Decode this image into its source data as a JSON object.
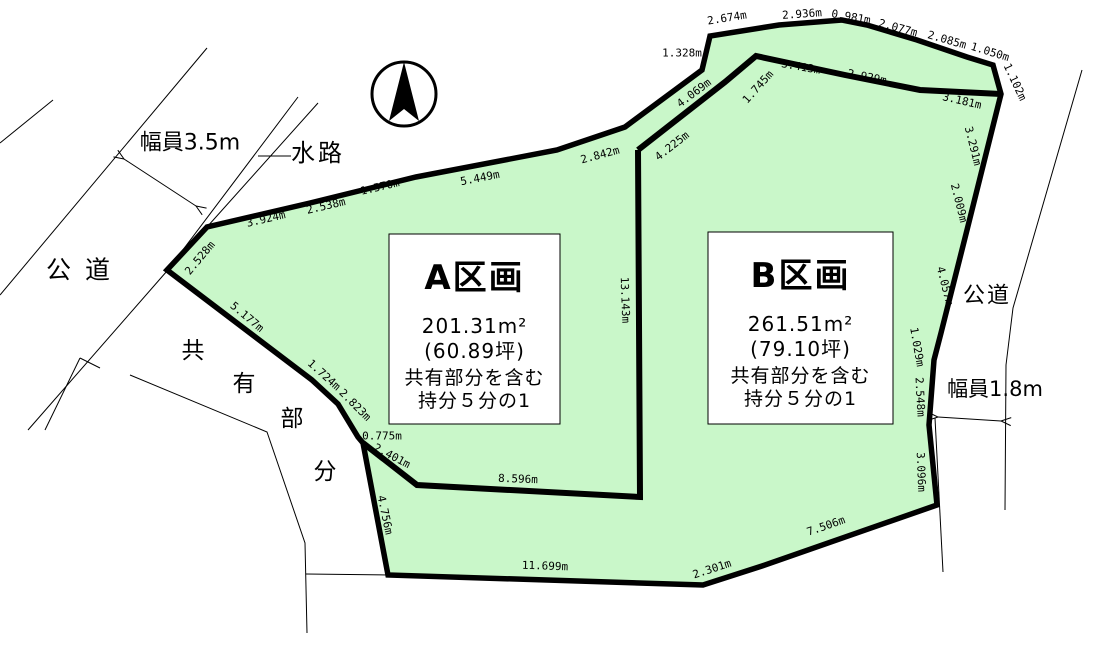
{
  "colors": {
    "land_fill": "#c9f7c9",
    "line": "#000000",
    "background": "#ffffff",
    "box_fill": "#ffffff"
  },
  "compass": {
    "name": "north-compass",
    "cx": 404,
    "cy": 94,
    "r": 32,
    "needle_points": "404,62 419,121 404,109 389,121"
  },
  "outer_boundary": {
    "name": "land-outer-boundary",
    "points": "167,270 207,227 310,203 375,187 416,177 557,150 625,127 702,70 710,36 779,25 842,20 867,25 917,40 967,57 993,65 1001,94 980,178 967,230 941,333 934,360 929,425 937,505 762,566 703,585 388,575 363,443 358,437 338,404 312,380"
  },
  "inner_lines": [
    {
      "name": "parcel-divider-line",
      "points": "638,150 640,497 417,485 363,443"
    },
    {
      "name": "north-strip-inner-line",
      "points": "638,150 725,82 756,56 845,75 920,90 1001,94"
    }
  ],
  "thin_lines": [
    {
      "name": "west-road-west-edge-line",
      "points": "207,48 0,295"
    },
    {
      "name": "west-road-far-edge-line",
      "points": "53,100 0,143"
    },
    {
      "name": "waterway-west-edge-line",
      "points": "298,97 167,271 28,430"
    },
    {
      "name": "waterway-east-edge-line",
      "points": "318,103 207,227"
    },
    {
      "name": "waterway-leader-line",
      "points": "258,156 291,156"
    },
    {
      "name": "shared-area-west-boundary-line",
      "points": "130,375 267,432 305,543 307,633"
    },
    {
      "name": "shared-area-bottom-line",
      "points": "306,574 388,575"
    },
    {
      "name": "parcel-jog-line-1",
      "points": "100,368 80,358"
    },
    {
      "name": "parcel-jog-line-2",
      "points": "80,358 45,430"
    },
    {
      "name": "east-road-edge-line",
      "points": "1082,70 1013,308 1006,365 1005,510"
    },
    {
      "name": "east-boundary-extension-line",
      "points": "935,418 943,572"
    }
  ],
  "arrows": [
    {
      "name": "road-width-arrow-west",
      "x1": 124,
      "y1": 159,
      "x2": 196,
      "y2": 206
    },
    {
      "name": "road-width-arrow-east",
      "x1": 938,
      "y1": 417,
      "x2": 1001,
      "y2": 421
    }
  ],
  "measurements": [
    {
      "text": "2.528m",
      "x": 200,
      "y": 258,
      "rot": -50
    },
    {
      "text": "3.924m",
      "x": 266,
      "y": 219,
      "rot": -13
    },
    {
      "text": "2.538m",
      "x": 326,
      "y": 206,
      "rot": -13
    },
    {
      "text": "1.570m",
      "x": 380,
      "y": 187,
      "rot": -13
    },
    {
      "text": "5.449m",
      "x": 480,
      "y": 178,
      "rot": -11
    },
    {
      "text": "2.842m",
      "x": 600,
      "y": 155,
      "rot": -15
    },
    {
      "text": "4.069m",
      "x": 694,
      "y": 93,
      "rot": -37
    },
    {
      "text": "1.328m",
      "x": 682,
      "y": 53,
      "rot": 0
    },
    {
      "text": "2.674m",
      "x": 727,
      "y": 18,
      "rot": -9
    },
    {
      "text": "2.936m",
      "x": 802,
      "y": 14,
      "rot": -4
    },
    {
      "text": "0.981m",
      "x": 851,
      "y": 17,
      "rot": 10
    },
    {
      "text": "2.077m",
      "x": 898,
      "y": 28,
      "rot": 15
    },
    {
      "text": "2.085m",
      "x": 947,
      "y": 40,
      "rot": 16
    },
    {
      "text": "1.050m",
      "x": 990,
      "y": 52,
      "rot": 17
    },
    {
      "text": "1.102m",
      "x": 1015,
      "y": 82,
      "rot": 65
    },
    {
      "text": "4.225m",
      "x": 672,
      "y": 146,
      "rot": -38
    },
    {
      "text": "1.745m",
      "x": 758,
      "y": 87,
      "rot": -48
    },
    {
      "text": "3.413m",
      "x": 801,
      "y": 67,
      "rot": 10
    },
    {
      "text": "2.929m",
      "x": 867,
      "y": 77,
      "rot": 11
    },
    {
      "text": "3.181m",
      "x": 962,
      "y": 101,
      "rot": 13
    },
    {
      "text": "3.291m",
      "x": 973,
      "y": 146,
      "rot": 76
    },
    {
      "text": "2.009m",
      "x": 959,
      "y": 203,
      "rot": 76
    },
    {
      "text": "4.057m",
      "x": 945,
      "y": 286,
      "rot": 76
    },
    {
      "text": "1.029m",
      "x": 917,
      "y": 347,
      "rot": 80
    },
    {
      "text": "2.548m",
      "x": 920,
      "y": 397,
      "rot": 87
    },
    {
      "text": "3.096m",
      "x": 921,
      "y": 472,
      "rot": 88
    },
    {
      "text": "7.506m",
      "x": 826,
      "y": 526,
      "rot": -19
    },
    {
      "text": "2.301m",
      "x": 712,
      "y": 569,
      "rot": -18
    },
    {
      "text": "11.699m",
      "x": 545,
      "y": 566,
      "rot": 2
    },
    {
      "text": "4.756m",
      "x": 385,
      "y": 515,
      "rot": 78
    },
    {
      "text": "2.401m",
      "x": 392,
      "y": 456,
      "rot": 28
    },
    {
      "text": "0.775m",
      "x": 382,
      "y": 436,
      "rot": 0
    },
    {
      "text": "8.596m",
      "x": 518,
      "y": 479,
      "rot": 2
    },
    {
      "text": "13.143m",
      "x": 625,
      "y": 300,
      "rot": 88
    },
    {
      "text": "1.724m",
      "x": 324,
      "y": 375,
      "rot": 42
    },
    {
      "text": "2.823m",
      "x": 355,
      "y": 405,
      "rot": 45
    },
    {
      "text": "5.177m",
      "x": 247,
      "y": 317,
      "rot": 40
    }
  ],
  "area_labels": [
    {
      "name": "road-label-west",
      "text": "公道",
      "x": 85,
      "y": 270,
      "size": 25,
      "spacing": 14
    },
    {
      "name": "waterway-label",
      "text": "水路",
      "x": 318,
      "y": 153,
      "size": 24,
      "spacing": 3
    },
    {
      "name": "road-label-east",
      "text": "公道",
      "x": 987,
      "y": 296,
      "size": 22,
      "spacing": 2
    },
    {
      "name": "road-width-label-west",
      "text": "幅員3.5m",
      "x": 190,
      "y": 143,
      "size": 22,
      "spacing": 0
    },
    {
      "name": "road-width-label-east",
      "text": "幅員1.8m",
      "x": 995,
      "y": 389,
      "size": 21,
      "spacing": 0
    },
    {
      "name": "shared-area-label-char-1",
      "text": "共",
      "x": 193,
      "y": 351,
      "size": 23,
      "spacing": 0
    },
    {
      "name": "shared-area-label-char-2",
      "text": "有",
      "x": 244,
      "y": 384,
      "size": 23,
      "spacing": 0
    },
    {
      "name": "shared-area-label-char-3",
      "text": "部",
      "x": 292,
      "y": 419,
      "size": 23,
      "spacing": 0
    },
    {
      "name": "shared-area-label-char-4",
      "text": "分",
      "x": 325,
      "y": 472,
      "size": 23,
      "spacing": 0
    }
  ],
  "info_boxes": [
    {
      "name": "parcel-a-info-box",
      "x": 389,
      "y": 234,
      "w": 171,
      "h": 190,
      "title": "A区画",
      "lines": [
        "201.31m²",
        "(60.89坪)",
        "共有部分を含む",
        "持分５分の1"
      ]
    },
    {
      "name": "parcel-b-info-box",
      "x": 708,
      "y": 232,
      "w": 185,
      "h": 192,
      "title": "B区画",
      "lines": [
        "261.51m²",
        "(79.10坪)",
        "共有部分を含む",
        "持分５分の1"
      ]
    }
  ]
}
